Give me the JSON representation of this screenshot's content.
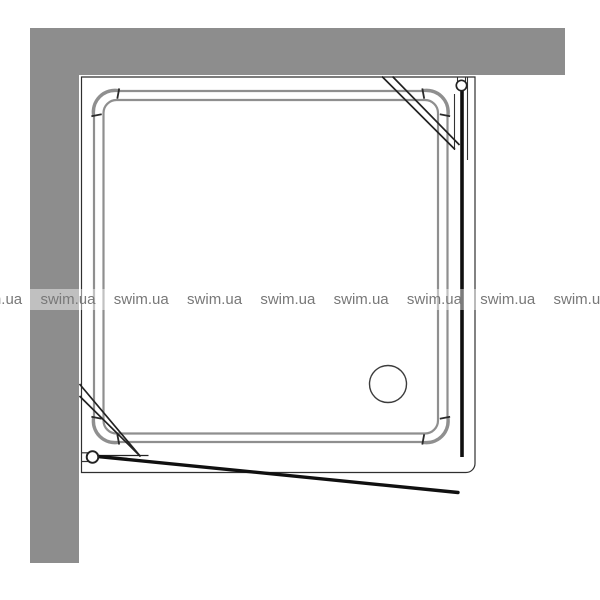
{
  "watermark": {
    "text": "swim.ua",
    "repeat_count": 9,
    "text_color": "#787878",
    "band_color": "rgba(255,255,255,0.45)"
  },
  "colors": {
    "background": "#ffffff",
    "wall": "#8d8d8d",
    "tray_rim": "#8f8f8f",
    "frame_line": "#2f2f2f",
    "glass_line": "#101010"
  },
  "elements": {
    "left_wall": "left wall",
    "top_wall": "top wall",
    "enclosure_frame": "enclosure frame outline",
    "tray": "square shower tray with rounded rim",
    "drain": "drain",
    "top_right_hinge": "top-right door hinge",
    "bottom_left_hinge": "bottom-left door hinge",
    "fixed_glass_panel": "right fixed glass panel (closed position)",
    "open_door_panel": "front door shown open",
    "corner_struts": "diagonal corner struts"
  }
}
